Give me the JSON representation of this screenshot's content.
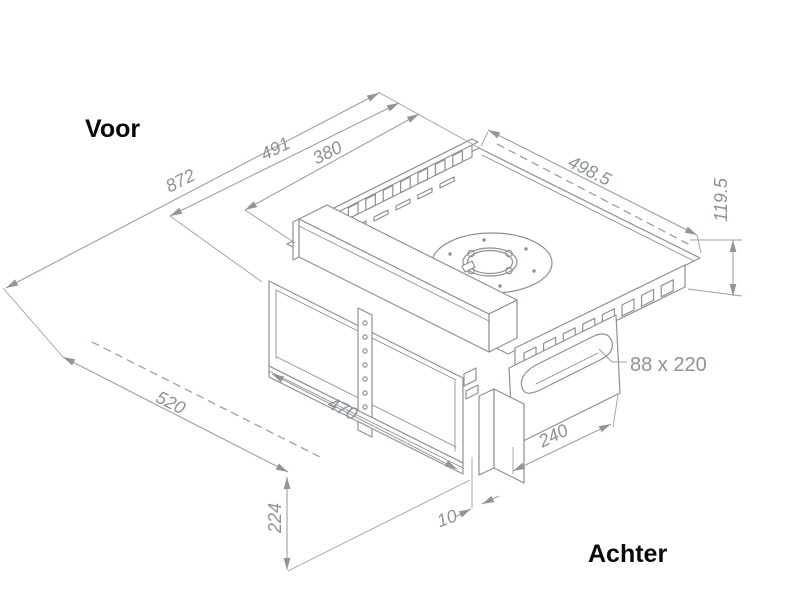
{
  "labels": {
    "front": "Voor",
    "back": "Achter"
  },
  "dimensions": {
    "dim_872": "872",
    "dim_491": "491",
    "dim_380": "380",
    "dim_498_5": "498.5",
    "dim_119_5": "119.5",
    "dim_88x220": "88 x 220",
    "dim_520": "520",
    "dim_470": "470",
    "dim_240": "240",
    "dim_10": "10",
    "dim_224": "224"
  },
  "colors": {
    "line": "#8b9196",
    "dimension_line": "#9aa0a5",
    "dimension_text": "#8c9297",
    "label_text": "#0a0a0a",
    "background": "#ffffff"
  }
}
